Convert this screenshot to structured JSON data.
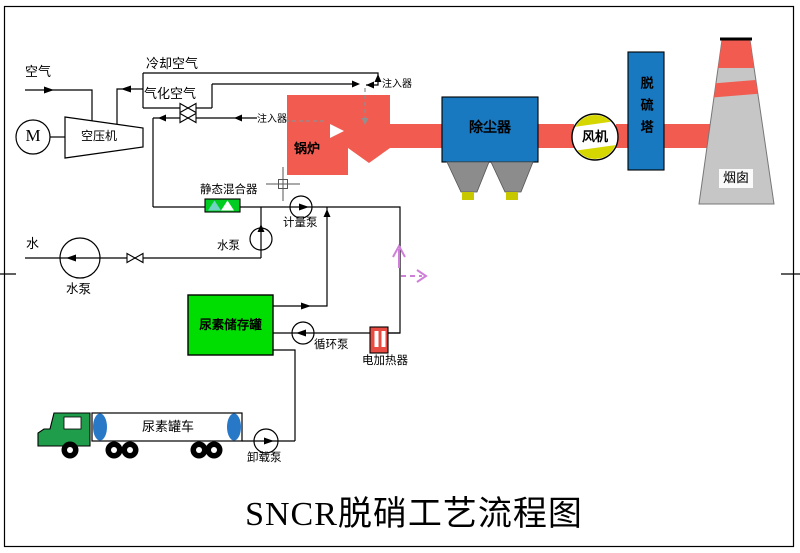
{
  "window": {
    "width": 800,
    "height": 553
  },
  "diagram": {
    "title": "SNCR脱硝工艺流程图",
    "labels": {
      "air": "空气",
      "cooling_air": "冷却空气",
      "gasification_air": "气化空气",
      "motor": "M",
      "compressor": "空压机",
      "injector_upper": "注入器",
      "injector_left": "注入器",
      "boiler": "锅炉",
      "dust_collector": "除尘器",
      "fan": "风机",
      "desulfurization_tower": "脱硫塔",
      "chimney": "烟囱",
      "static_mixer": "静态混合器",
      "metering_pump": "计量泵",
      "water": "水",
      "water_pump_main": "水泵",
      "water_pump_small": "水泵",
      "urea_tank": "尿素储存罐",
      "circulation_pump": "循环泵",
      "electric_heater": "电加热器",
      "urea_truck": "尿素罐车",
      "unloading_pump": "卸载泵"
    },
    "colors": {
      "flue_red": "#f15b50",
      "equip_blue": "#1878c0",
      "tank_green": "#00dd00",
      "mixer_green": "#00cc22",
      "cab_green": "#1f9d4b",
      "heater_red": "#e84b42",
      "fan_yellow": "#d6d600",
      "hopper_gray": "#8c8c8c",
      "chimney_gray": "#c6c6c6",
      "artifact_pink": "#cf7fd9",
      "cap_blue": "#2878c8",
      "foot_yellow": "#c8c800",
      "line_black": "#000000"
    }
  }
}
